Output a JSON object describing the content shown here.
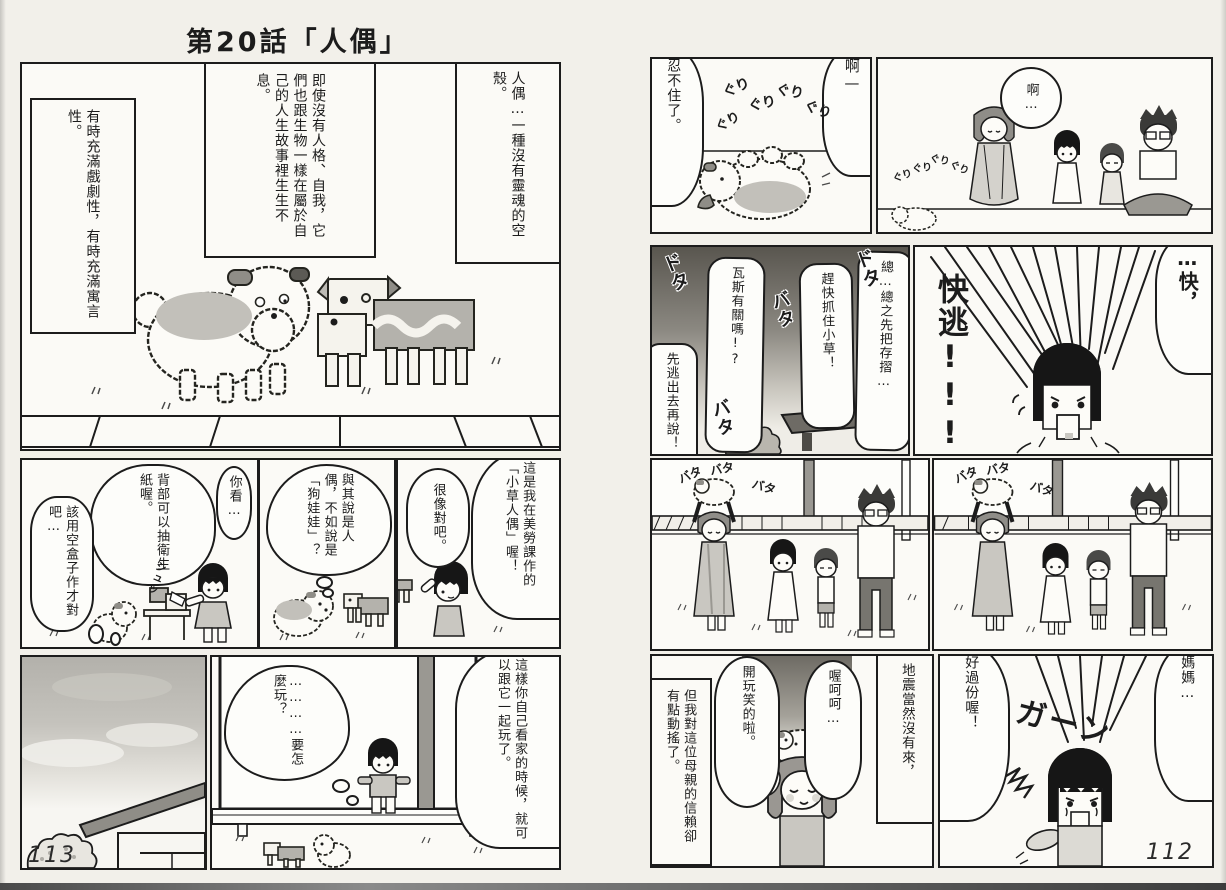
{
  "title": "第20話「人偶」",
  "page_numbers": {
    "left": "113",
    "right": "112"
  },
  "colors": {
    "paper": "#f2f0ea",
    "panel": "#fbfaf6",
    "ink": "#1c1c1c",
    "halftone": "#b9b7b1"
  },
  "left_page": {
    "intro_panel": {
      "caption_doll": "人偶…一種沒有靈魂的空殼。",
      "caption_life": "即使沒有人格、自我，它們也跟生物一樣在屬於自己的人生故事裡生生不息。",
      "caption_drama": "有時充滿戲劇性，有時充滿寓言性。"
    },
    "tissue_panel": {
      "bubble_look": "你看…",
      "bubble_tissue": "背部可以抽衛生紙喔。",
      "thought_box": "該用空盒子作才對吧…",
      "sfx_swish": "シュッ"
    },
    "dog_doll_panel": {
      "thought": "與其說是人偶，不如說是「狗娃娃」？"
    },
    "craft_panel": {
      "bubble_intro": "這是我在美勞課作的「小草人偶」喔！",
      "bubble_alike": "很像對吧。"
    },
    "window_panel": {
      "bubble_play": "這樣你自己看家的時候，就可以跟它一起玩了。",
      "thought_how": "…………要怎麼玩？"
    }
  },
  "right_page": {
    "rolling_panel": {
      "bubble_ah": "啊—",
      "bubble_cant_resist": "忍不住了。",
      "sfx_guri": "ぐり"
    },
    "family_watch_panel": {
      "bubble_ah": "啊…",
      "sfx_guri": "ぐり"
    },
    "panic_panel": {
      "bubble_passbook": "總…總之先把存摺…",
      "bubble_grab": "趕快抓住小草！",
      "bubble_gas": "瓦斯有關嗎!?",
      "bubble_escape": "先逃出去再說！",
      "sfx_dota": "ドタ",
      "sfx_bata": "バタ"
    },
    "run_panel": {
      "bubble_quick": "…快，",
      "shout_run": "快逃!!!"
    },
    "outside_panel_1": {
      "sfx_bata": "バタ"
    },
    "outside_panel_2": {
      "sfx_bata": "バタ"
    },
    "joke_panel": {
      "box_earthquake": "地震當然沒有來，",
      "bubble_ohoho": "喔呵呵…",
      "bubble_joking": "開玩笑的啦。",
      "box_trust": "但我對這位母親的信賴卻有點動搖了。"
    },
    "upset_panel": {
      "bubble_mama": "媽媽…",
      "bubble_too_much": "好過份喔！",
      "sfx_gaan": "ガーン"
    }
  }
}
